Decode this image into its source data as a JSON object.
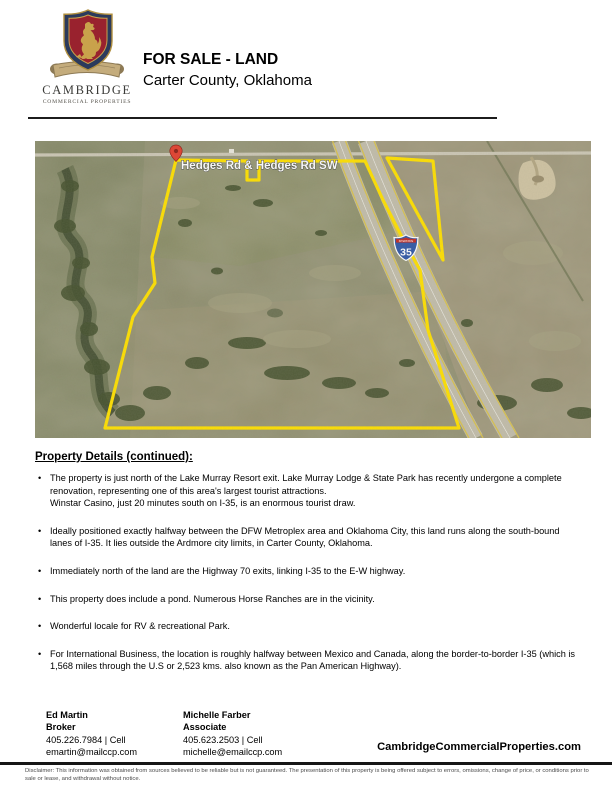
{
  "header": {
    "logo_name": "CAMBRIDGE",
    "logo_subtitle": "COMMERCIAL PROPERTIES",
    "title": "FOR SALE - LAND",
    "subtitle": "Carter County, Oklahoma"
  },
  "map": {
    "road_label": "Hedges Rd & Hedges Rd SW",
    "shield": {
      "label": "INTERSTATE",
      "number": "35"
    },
    "boundary_color": "#ffe000"
  },
  "details": {
    "heading": "Property Details (continued):",
    "bullets": [
      "The property is just north of the Lake Murray Resort exit. Lake Murray Lodge & State Park has recently undergone a complete renovation, representing one of this area's largest tourist attractions.\nWinstar Casino, just 20 minutes south on I-35, is an enormous tourist draw.",
      "Ideally positioned exactly halfway between the DFW Metroplex area and Oklahoma City, this land runs along the south-bound lanes of I-35. It lies outside the Ardmore city limits, in Carter County, Oklahoma.",
      "Immediately north of the land are the Highway 70 exits, linking I-35 to the E-W highway.",
      "This property does include a pond. Numerous Horse Ranches are in the vicinity.",
      "Wonderful locale for RV & recreational Park.",
      "For International Business, the location is roughly halfway between Mexico and Canada, along the border-to-border I-35 (which is 1,568 miles through the U.S or 2,523 kms. also known as the Pan American Highway)."
    ]
  },
  "footer": {
    "contacts": [
      {
        "name": "Ed Martin",
        "title": "Broker",
        "phone": "405.226.7984 | Cell",
        "email": "emartin@mailccp.com"
      },
      {
        "name": "Michelle Farber",
        "title": "Associate",
        "phone": "405.623.2503 | Cell",
        "email": "michelle@emailccp.com"
      }
    ],
    "website": "CambridgeCommercialProperties.com",
    "disclaimer": "Disclaimer: This information was obtained from sources believed to be reliable but is not guaranteed. The presentation of this property is being offered subject to errors, omissions, change of price, or conditions prior to sale or lease, and withdrawal without notice."
  }
}
